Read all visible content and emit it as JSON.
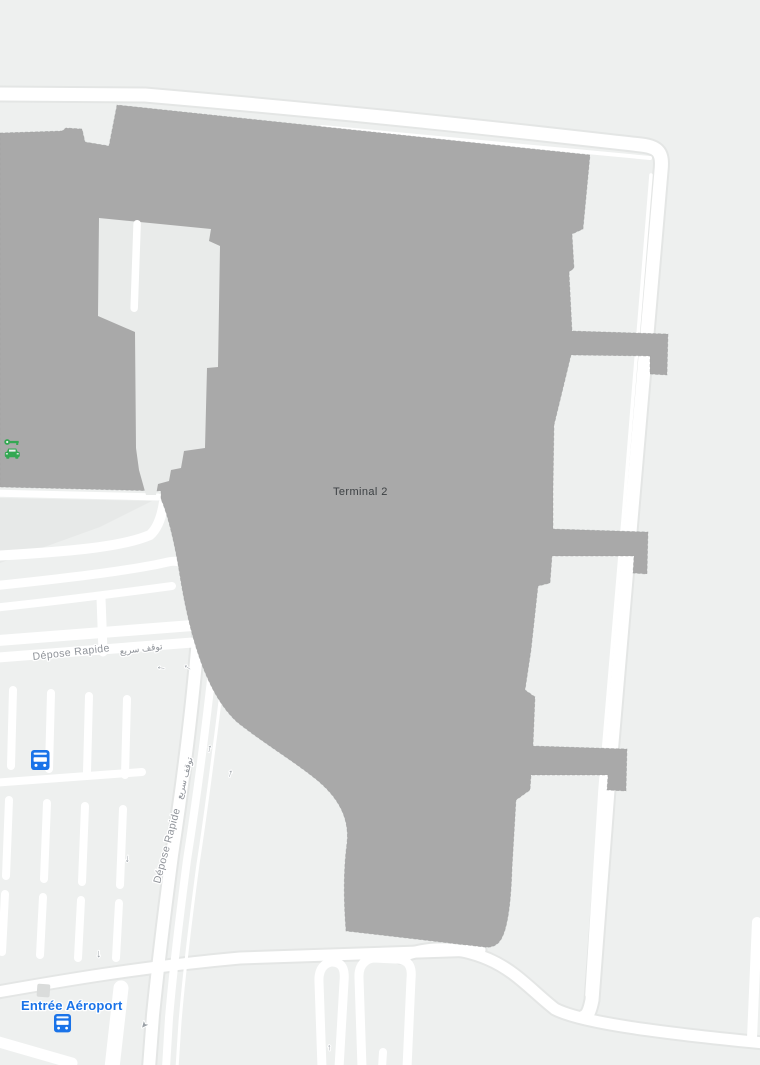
{
  "map": {
    "labels": {
      "terminal": "Terminal 2",
      "airport_entrance": "Entrée Aéroport",
      "dropoff_fr": "Dépose Rapide",
      "dropoff_ar": "توقف سريع"
    },
    "glyphs": {
      "arrow_left": "←",
      "arrow_up": "↑",
      "arrow_down": "↓",
      "arrow_cursor": "➤"
    },
    "icons": [
      {
        "name": "car-rental-icon",
        "color": "#34a853"
      },
      {
        "name": "bus-station-icon",
        "color": "#1a73e8"
      },
      {
        "name": "bus-station-icon",
        "color": "#1a73e8"
      },
      {
        "name": "building-poi-icon",
        "color": "#dadcdb"
      }
    ],
    "colors": {
      "background": "#eef0ef",
      "building": "#a9a9a9",
      "building_inner_yard": "#e9ebea",
      "road": "#ffffff",
      "apron_triangle": "#e7e9e8",
      "road_label": "#8f9399",
      "terminal_label": "#3c4043",
      "poi_blue": "#1a73e8",
      "transit_green": "#34a853",
      "arrow_gray": "#9aa0a6"
    }
  }
}
